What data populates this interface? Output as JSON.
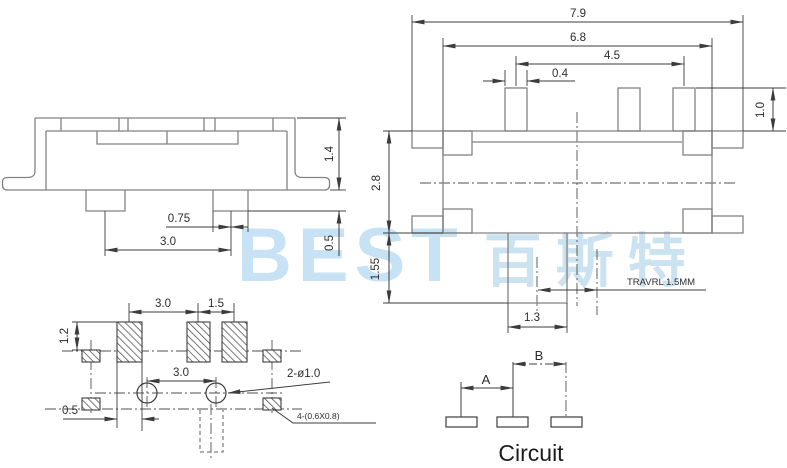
{
  "watermark": {
    "brand": "BEST",
    "brand_cjk": "百斯特",
    "color": "#c6e2f4"
  },
  "side_view": {
    "dim_pin_pitch": "3.0",
    "dim_pin_width": "0.75",
    "dim_body_height": "1.4",
    "dim_pin_height": "0.5"
  },
  "top_view": {
    "dim_overall_width": "7.9",
    "dim_body_width": "6.8",
    "dim_pin_span": "4.5",
    "dim_pin_width": "0.4",
    "dim_pin_length": "1.0",
    "dim_body_height": "2.8",
    "dim_knob_length": "1.55",
    "dim_knob_width": "1.3",
    "travel_note": "TRAVRL 1.5MM"
  },
  "footprint": {
    "dim_pad_pitch": "3.0",
    "dim_pad_gap": "1.5",
    "dim_pad_height": "1.2",
    "dim_hole_pitch": "3.0",
    "hole_note": "2-ø1.0",
    "dim_edge_offset": "0.5",
    "slot_note": "4-(0.6X0.8)"
  },
  "circuit": {
    "dim_a": "A",
    "dim_b": "B",
    "caption": "Circuit"
  }
}
